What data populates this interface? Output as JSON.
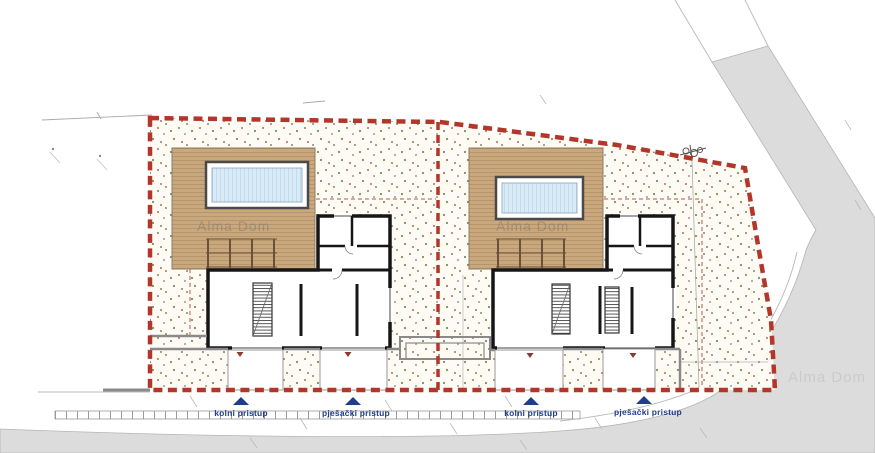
{
  "drawing": {
    "type": "architectural-site-plan",
    "watermarks": {
      "left_house": "Alma Dom",
      "right_house": "Alma Dom",
      "road": "Alma Dom"
    },
    "access": {
      "items": [
        {
          "label": "kolni pristup"
        },
        {
          "label": "pješački pristup"
        },
        {
          "label": "kolni pristup"
        },
        {
          "label": "pješački pristup"
        }
      ]
    }
  },
  "colors": {
    "boundary": "#b3362b",
    "setback": "#b05a48",
    "access": "#1e3e8c",
    "road": "#dcdcdc",
    "deck": "#c9a87e",
    "deck_line": "#b6946c",
    "pool": "#d9ebf6",
    "pool_line": "#c2dcee",
    "wall": "#161616",
    "gray_wall": "#8a8a8a",
    "parcel_bg": "#fdfbf4",
    "dot_green": "#7d8f5e",
    "dot_brown": "#a5745c",
    "dot_gray": "#9a9a9a",
    "pergola": "#6b5138",
    "door_mark": "#8b3a2f",
    "line_faint": "#b5b5b5"
  }
}
